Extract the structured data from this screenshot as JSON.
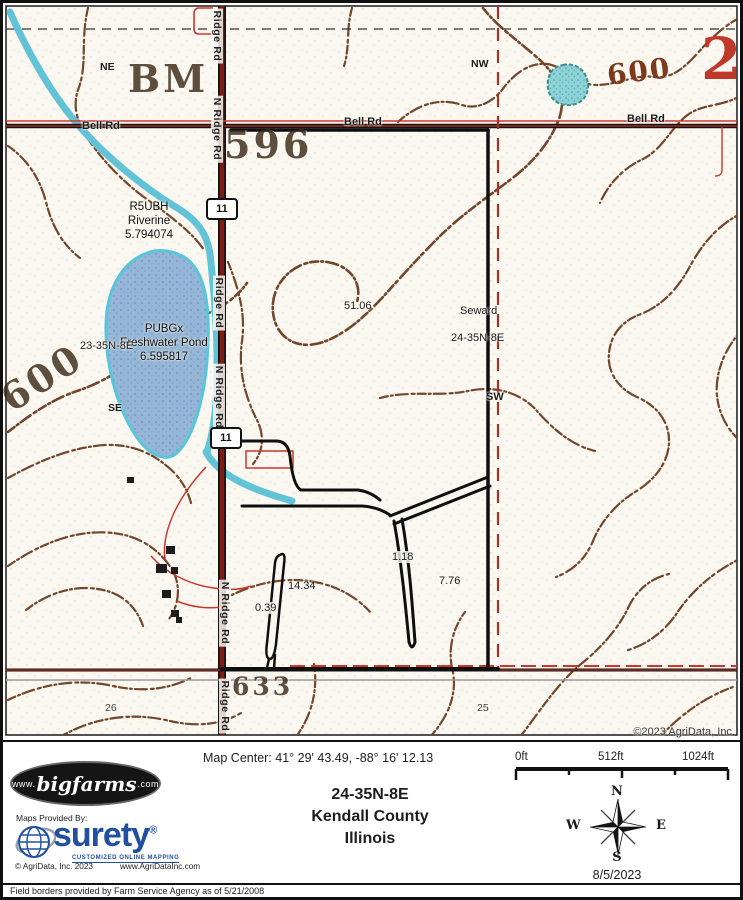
{
  "map": {
    "corner_number": "2",
    "quadrants": {
      "ne": "NE",
      "nw": "NW",
      "se": "SE",
      "sw": "SW"
    },
    "roads": {
      "bell": "Bell Rd",
      "ridge": "Ridge Rd",
      "n_ridge": "N Ridge Rd"
    },
    "route_shield": "11",
    "elevations": {
      "e596": "596",
      "e600": "600",
      "e633": "633",
      "benchmark": "BM"
    },
    "wetlands": {
      "riverine": {
        "code": "R5UBH",
        "type": "Riverine",
        "acres": "5.794074"
      },
      "pond": {
        "code": "PUBGx",
        "type": "Freshwater Pond",
        "acres": "6.595817"
      }
    },
    "sections": {
      "left": "23-35N-8E",
      "right": "24-35N-8E",
      "township": "Seward",
      "number_left": "26",
      "number_right": "25"
    },
    "areas": {
      "north": "51.06",
      "fork": "1.18",
      "east": "7.76",
      "mid": "14.34",
      "sliver": "0.39"
    },
    "copyright": "©2023 AgriData, Inc."
  },
  "footer": {
    "map_center": "Map Center: 41° 29' 43.49,  -88° 16' 12.13",
    "scale": {
      "t0": "0ft",
      "t1": "512ft",
      "t2": "1024ft"
    },
    "title": {
      "line1": "24-35N-8E",
      "line2": "Kendall County",
      "line3": "Illinois"
    },
    "bigfarms": {
      "prefix": "www.",
      "name": "bigfarms",
      "suffix": ".com"
    },
    "provided_by": "Maps Provided By:",
    "surety": {
      "name": "surety",
      "reg": "®",
      "tagline": "CUSTOMIZED ONLINE MAPPING",
      "copyright": "© AgriData, Inc. 2023",
      "url": "www.AgriDataInc.com"
    },
    "compass": {
      "n": "N",
      "e": "E",
      "s": "S",
      "w": "W"
    },
    "date": "8/5/2023",
    "disclaimer": "Field borders provided by Farm Service Agency as of 5/21/2008"
  },
  "colors": {
    "road": "#7b1d14",
    "water": "#63c3d6",
    "pond_fill": "#95b6d6",
    "contour": "#6b3d20",
    "section_line": "#a23326",
    "field_border_red": "#c9382b",
    "surety_blue": "#20509f",
    "corner_red": "#c0392b"
  }
}
